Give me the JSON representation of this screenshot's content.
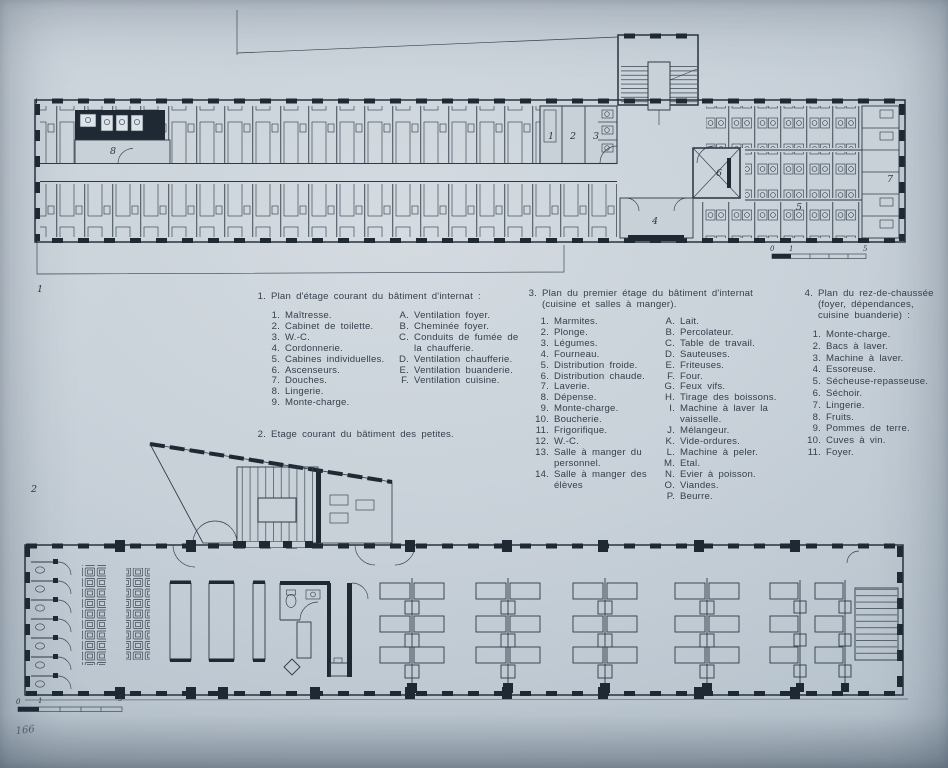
{
  "page": {
    "number": "166"
  },
  "plan1": {
    "figure_no": "1",
    "room_labels": {
      "r1": "1",
      "r2": "2",
      "r3": "3",
      "r4": "4",
      "r5": "5",
      "r6": "6",
      "r7": "7",
      "r8": "8"
    },
    "scale": {
      "s0": "0",
      "s1": "1",
      "s5": "5"
    }
  },
  "plan2": {
    "figure_no": "2",
    "scale": {
      "s0": "0",
      "s1": "1",
      "s5": "5"
    }
  },
  "legends": {
    "legend1": {
      "num": "1.",
      "title": "Plan d'étage courant du bâtiment d'internat :",
      "numbered": [
        {
          "num": "1.",
          "label": "Maîtresse."
        },
        {
          "num": "2.",
          "label": "Cabinet de toilette."
        },
        {
          "num": "3.",
          "label": "W.-C."
        },
        {
          "num": "4.",
          "label": "Cordonnerie."
        },
        {
          "num": "5.",
          "label": "Cabines individuelles."
        },
        {
          "num": "6.",
          "label": "Ascenseurs."
        },
        {
          "num": "7.",
          "label": "Douches."
        },
        {
          "num": "8.",
          "label": "Lingerie."
        },
        {
          "num": "9.",
          "label": "Monte-charge."
        }
      ],
      "lettered": [
        {
          "num": "A.",
          "label": "Ventilation foyer."
        },
        {
          "num": "B.",
          "label": "Cheminée foyer."
        },
        {
          "num": "C.",
          "label": "Conduits de fumée de la chaufferie."
        },
        {
          "num": "D.",
          "label": "Ventilation chaufferie."
        },
        {
          "num": "E.",
          "label": "Ventilation buanderie."
        },
        {
          "num": "F.",
          "label": "Ventilation cuisine."
        }
      ]
    },
    "legend2": {
      "num": "2.",
      "title": "Etage courant du bâtiment des petites."
    },
    "legend3": {
      "num": "3.",
      "title": "Plan du premier étage du bâtiment d'internat (cuisine et salles à manger).",
      "numbered": [
        {
          "num": "1.",
          "label": "Marmites."
        },
        {
          "num": "2.",
          "label": "Plonge."
        },
        {
          "num": "3.",
          "label": "Légumes."
        },
        {
          "num": "4.",
          "label": "Fourneau."
        },
        {
          "num": "5.",
          "label": "Distribution froide."
        },
        {
          "num": "6.",
          "label": "Distribution chaude."
        },
        {
          "num": "7.",
          "label": "Laverie."
        },
        {
          "num": "8.",
          "label": "Dépense."
        },
        {
          "num": "9.",
          "label": "Monte-charge."
        },
        {
          "num": "10.",
          "label": "Boucherie."
        },
        {
          "num": "11.",
          "label": "Frigorifique."
        },
        {
          "num": "12.",
          "label": "W.-C."
        },
        {
          "num": "13.",
          "label": "Salle à manger du personnel."
        },
        {
          "num": "14.",
          "label": "Salle à manger des élèves"
        }
      ],
      "lettered": [
        {
          "num": "A.",
          "label": "Lait."
        },
        {
          "num": "B.",
          "label": "Percolateur."
        },
        {
          "num": "C.",
          "label": "Table de travail."
        },
        {
          "num": "D.",
          "label": "Sauteuses."
        },
        {
          "num": "E.",
          "label": "Friteuses."
        },
        {
          "num": "F.",
          "label": "Four."
        },
        {
          "num": "G.",
          "label": "Feux vifs."
        },
        {
          "num": "H.",
          "label": "Tirage des boissons."
        },
        {
          "num": "I.",
          "label": "Machine à laver la vaisselle."
        },
        {
          "num": "J.",
          "label": "Mélangeur."
        },
        {
          "num": "K.",
          "label": "Vide-ordures."
        },
        {
          "num": "L.",
          "label": "Machine à peler."
        },
        {
          "num": "M.",
          "label": "Etal."
        },
        {
          "num": "N.",
          "label": "Evier à poisson."
        },
        {
          "num": "O.",
          "label": "Viandes."
        },
        {
          "num": "P.",
          "label": "Beurre."
        }
      ]
    },
    "legend4": {
      "num": "4.",
      "title": "Plan du rez-de-chaussée (foyer, dépendances, cuisine buanderie) :",
      "numbered": [
        {
          "num": "1.",
          "label": "Monte-charge."
        },
        {
          "num": "2.",
          "label": "Bacs à laver."
        },
        {
          "num": "3.",
          "label": "Machine à laver."
        },
        {
          "num": "4.",
          "label": "Essoreuse."
        },
        {
          "num": "5.",
          "label": "Sécheuse-repasseuse."
        },
        {
          "num": "6.",
          "label": "Séchoir."
        },
        {
          "num": "7.",
          "label": "Lingerie."
        },
        {
          "num": "8.",
          "label": "Fruits."
        },
        {
          "num": "9.",
          "label": "Pommes de terre."
        },
        {
          "num": "10.",
          "label": "Cuves à vin."
        },
        {
          "num": "11.",
          "label": "Foyer."
        }
      ]
    }
  },
  "colors": {
    "paper": "#c8d1d8",
    "ink": "#2e3a46",
    "wall": "#1e2933"
  }
}
